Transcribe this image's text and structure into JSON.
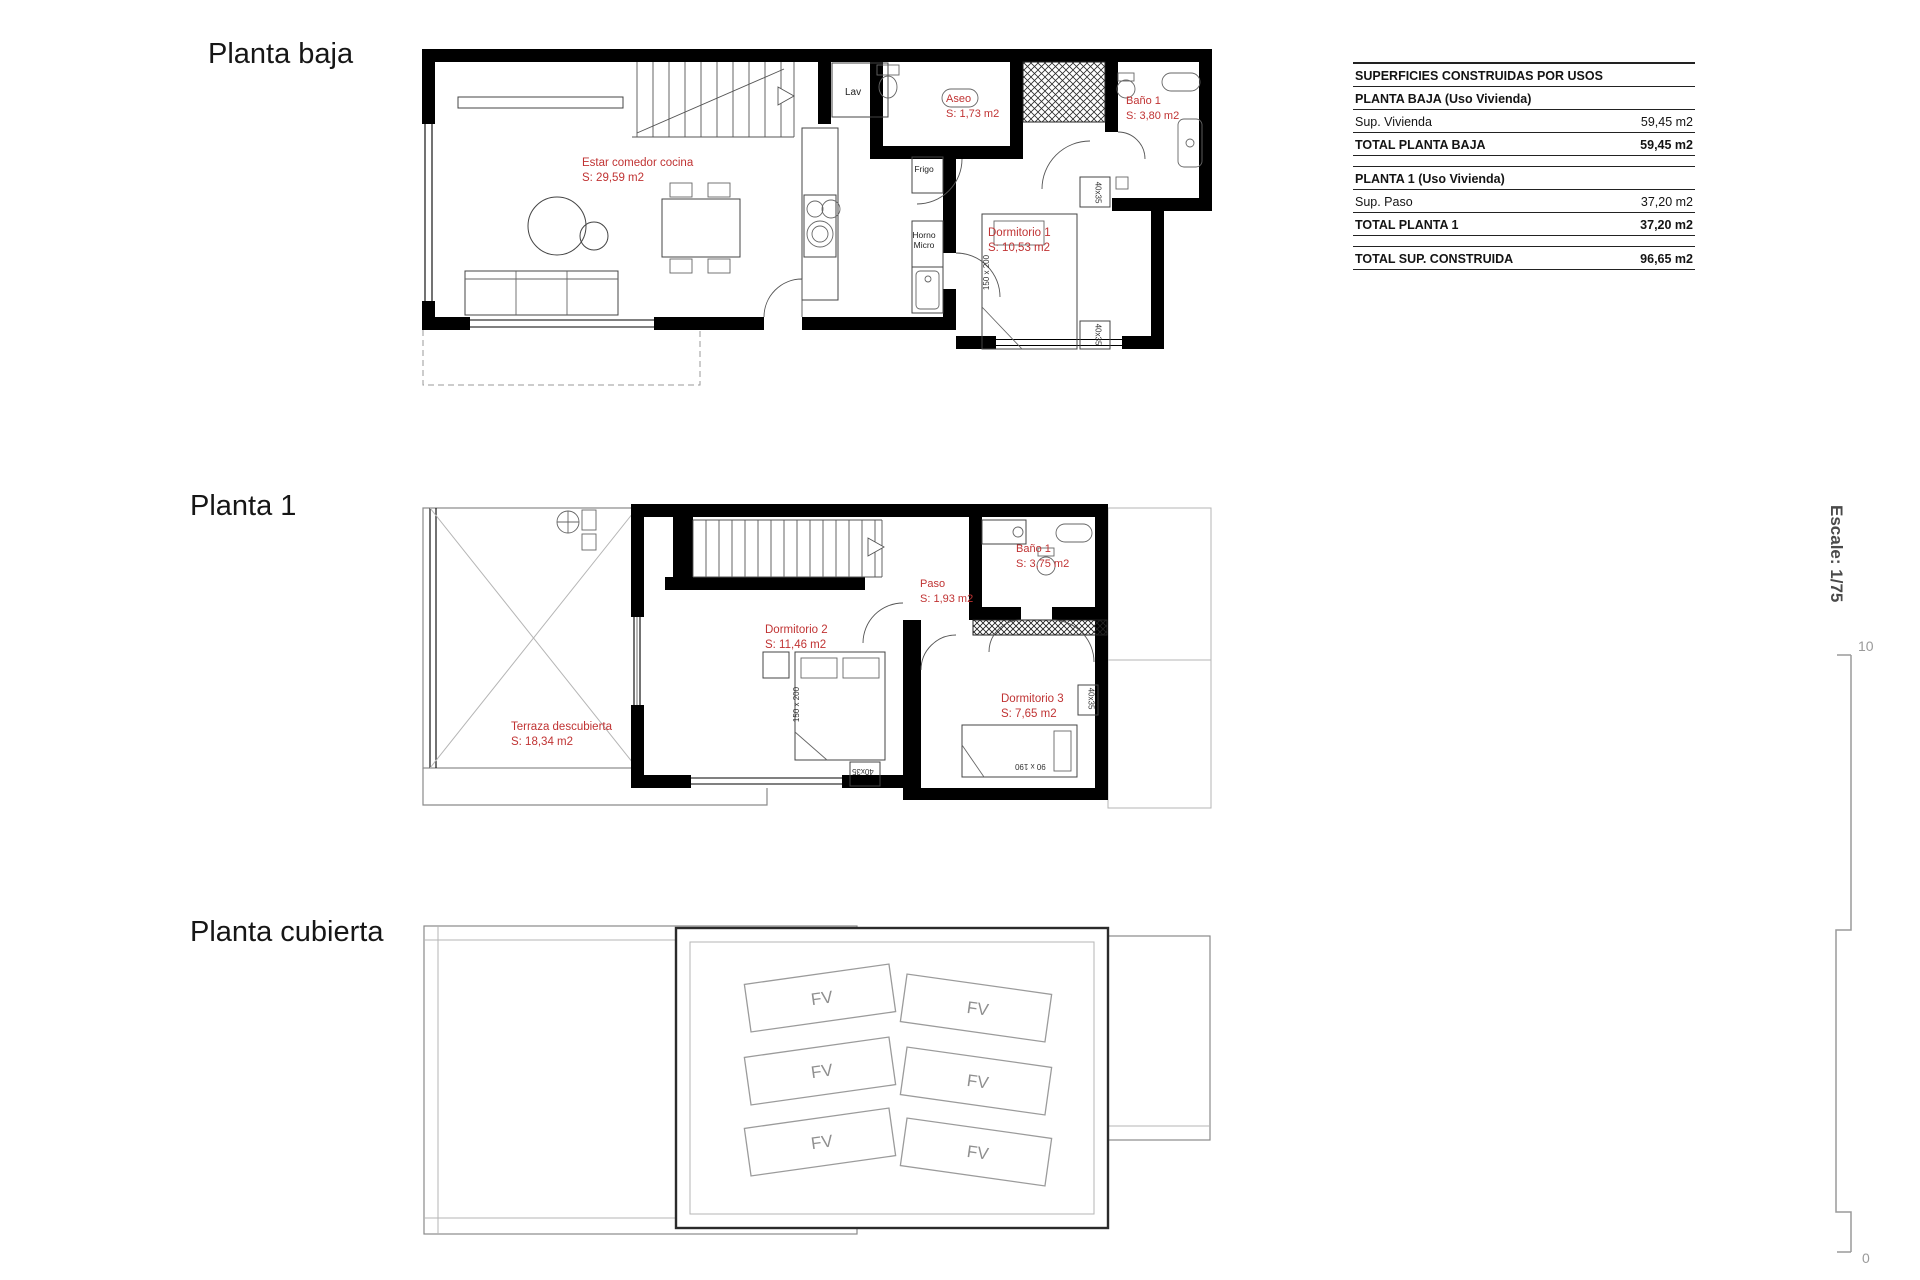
{
  "titles": {
    "planta_baja": "Planta baja",
    "planta_1": "Planta 1",
    "planta_cubierta": "Planta cubierta"
  },
  "areas_table": {
    "header": "SUPERFICIES CONSTRUIDAS POR USOS",
    "sections": [
      {
        "title": "PLANTA BAJA (Uso Vivienda)",
        "rows": [
          {
            "label": "Sup. Vivienda",
            "value": "59,45 m2"
          }
        ],
        "total": {
          "label": "TOTAL PLANTA BAJA",
          "value": "59,45 m2"
        }
      },
      {
        "title": "PLANTA 1 (Uso Vivienda)",
        "rows": [
          {
            "label": "Sup. Paso",
            "value": "37,20 m2"
          }
        ],
        "total": {
          "label": "TOTAL PLANTA 1",
          "value": "37,20 m2"
        }
      }
    ],
    "grand_total": {
      "label": "TOTAL SUP. CONSTRUIDA",
      "value": "96,65 m2"
    }
  },
  "rooms": {
    "planta_baja": {
      "estar": {
        "name": "Estar comedor cocina",
        "area": "S: 29,59 m2"
      },
      "aseo": {
        "name": "Aseo",
        "area": "S: 1,73 m2"
      },
      "bano1": {
        "name": "Baño 1",
        "area": "S: 3,80 m2"
      },
      "dormitorio1": {
        "name": "Dormitorio 1",
        "area": "S: 10,53 m2"
      },
      "lav": "Lav",
      "frigo": "Frigo",
      "horno_line1": "Horno",
      "horno_line2": "Micro"
    },
    "planta_1": {
      "terraza": {
        "name": "Terraza descubierta",
        "area": "S: 18,34 m2"
      },
      "dormitorio2": {
        "name": "Dormitorio 2",
        "area": "S: 11,46 m2"
      },
      "paso": {
        "name": "Paso",
        "area": "S: 1,93 m2"
      },
      "bano1": {
        "name": "Baño 1",
        "area": "S: 3,75 m2"
      },
      "dormitorio3": {
        "name": "Dormitorio 3",
        "area": "S: 7,65 m2"
      }
    },
    "planta_cubierta": {
      "panel_label": "FV"
    }
  },
  "dimensions": {
    "double_bed": "150 x 200",
    "single_bed": "90 x 190",
    "nightstand": "40x35"
  },
  "scale_bar": {
    "label": "Escale: 1/75",
    "top_value": "10",
    "bottom_value": "0"
  },
  "colors": {
    "label_red": "#c03333",
    "wall_black": "#000000",
    "panel_gray": "#9a9a9a"
  }
}
